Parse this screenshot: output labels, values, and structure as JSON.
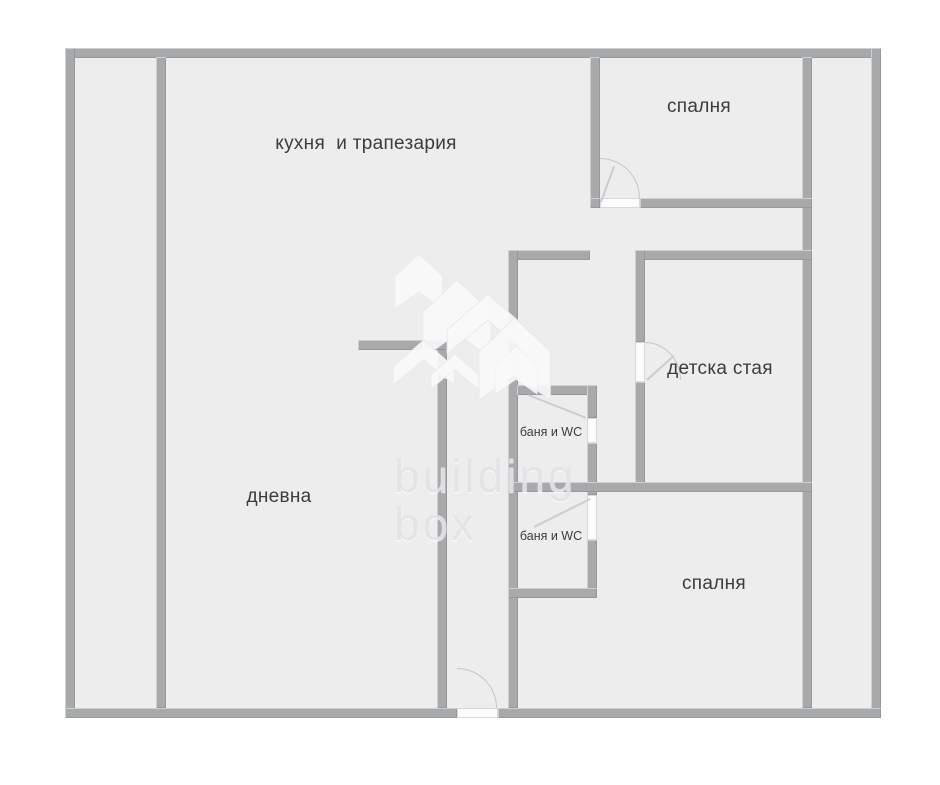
{
  "floorplan": {
    "rooms": {
      "kitchen_dining": {
        "label": "кухня  и трапезария"
      },
      "bedroom_top": {
        "label": "спалня"
      },
      "kids_room": {
        "label": "детска стая"
      },
      "living_room": {
        "label": "дневна"
      },
      "bathroom_top": {
        "label": "баня и WC"
      },
      "bathroom_bottom": {
        "label": "баня и WC"
      },
      "bedroom_bottom": {
        "label": "спалня"
      }
    },
    "watermark": {
      "line1": "building",
      "line2": "box"
    },
    "colors": {
      "background": "#ffffff",
      "floor": "#ededee",
      "wall": "#a8a9ab",
      "door_leaf": "#fcfcfd",
      "label_text": "#3c3c3c",
      "watermark_text": "#e4e4e8",
      "watermark_logo": "#f9f9fa"
    }
  }
}
